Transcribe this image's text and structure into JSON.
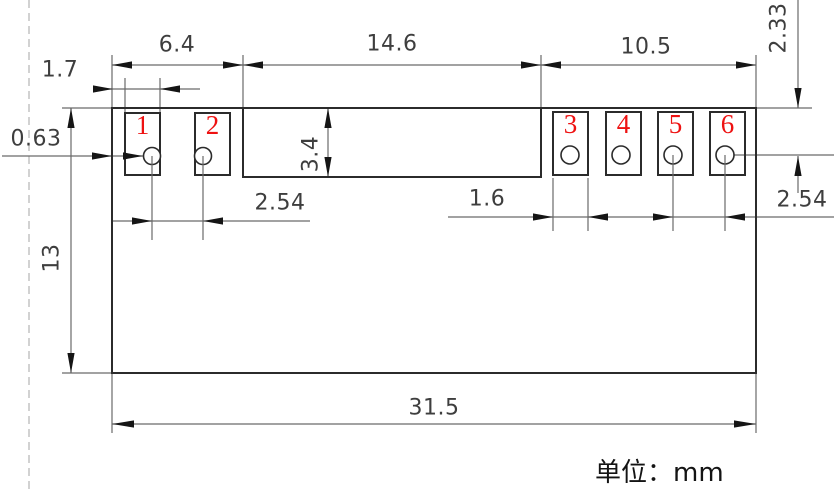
{
  "drawing": {
    "type": "mechanical-dimension-drawing",
    "unit_label": "单位：mm",
    "colors": {
      "background": "#ffffff",
      "outline": "#2b2b2b",
      "dimension_lines": "#6a6a6a",
      "dimension_text": "#3e3e3e",
      "pad_number_red": "#ee1111",
      "frame_dashed": "#b5b5b5"
    },
    "pads": [
      {
        "number": "1"
      },
      {
        "number": "2"
      },
      {
        "number": "3"
      },
      {
        "number": "4"
      },
      {
        "number": "5"
      },
      {
        "number": "6"
      }
    ],
    "dimensions": {
      "top_left_width": "6.4",
      "top_center_width": "14.6",
      "top_right_width": "10.5",
      "pad_width_left": "1.7",
      "edge_to_pad_offset": "0.63",
      "block_height": "3.4",
      "body_height": "13",
      "hole_center_from_top": "2.33",
      "hole_pitch_left": "2.54",
      "pad_width_right": "1.6",
      "hole_pitch_right": "2.54",
      "overall_width": "31.5"
    }
  }
}
